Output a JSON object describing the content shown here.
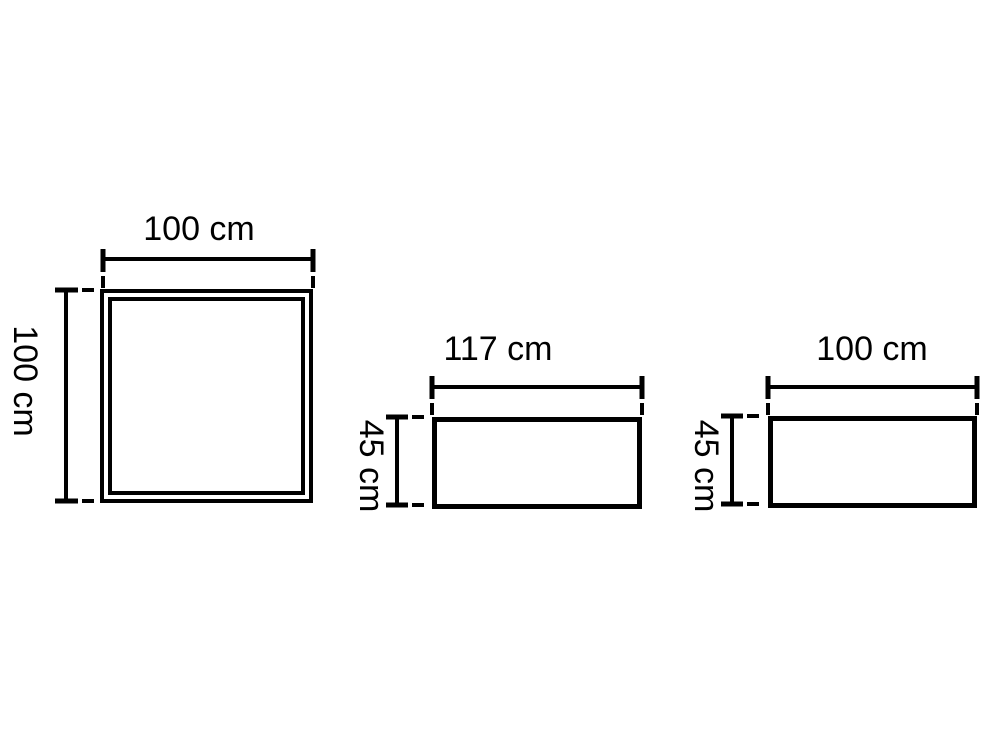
{
  "page": {
    "background_color": "#ffffff",
    "ink_color": "#000000"
  },
  "diagram": {
    "unit": "cm",
    "shapes": [
      {
        "id": "square-panel",
        "type": "square",
        "border": "double",
        "top_label": "100 cm",
        "side_label": "100 cm",
        "width_cm": 100,
        "height_cm": 100
      },
      {
        "id": "rectangle-117",
        "type": "rectangle",
        "border": "single",
        "top_label": "117 cm",
        "side_label": "45 cm",
        "width_cm": 117,
        "height_cm": 45
      },
      {
        "id": "rectangle-100",
        "type": "rectangle",
        "border": "single",
        "top_label": "100 cm",
        "side_label": "45 cm",
        "width_cm": 100,
        "height_cm": 45
      }
    ]
  }
}
